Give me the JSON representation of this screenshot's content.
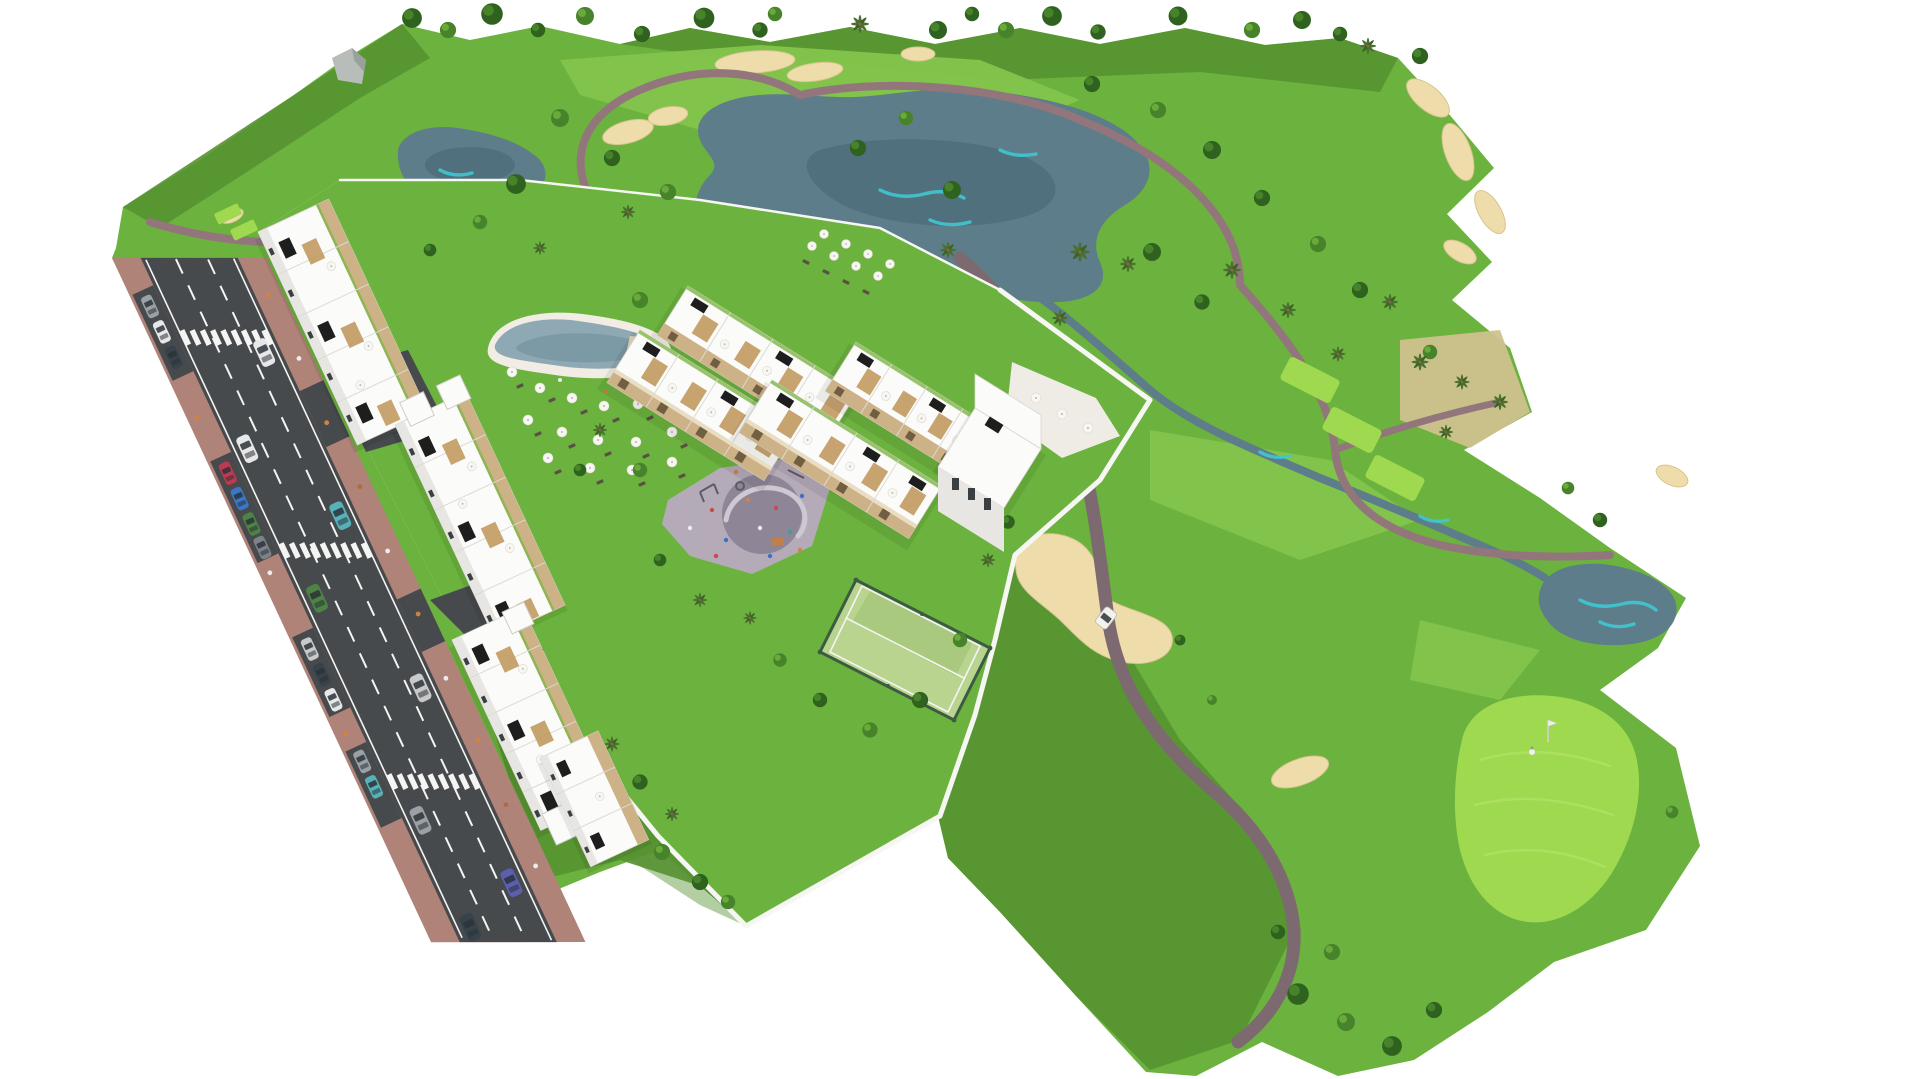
{
  "scene": {
    "kind": "aerial-3d-architectural-render",
    "subject": "golf-resort residential complex with apartment blocks, pool, padel court, playground, access road and golf course",
    "background": "#ffffff"
  },
  "palette": {
    "fairway": "#6cb23e",
    "rough": "#579231",
    "fairway_light": "#83c44c",
    "green_bright": "#9ed94f",
    "scrub": "#cfc28d",
    "sand": "#eedcaa",
    "water": "#5d7d8a",
    "water_deep": "#4d6b78",
    "water_accent": "#3fc8d2",
    "path": "#93767c",
    "path_dark": "#7d6a70",
    "road": "#474a4d",
    "road_line": "#f4f4f2",
    "sidewalk": "#b08379",
    "wall": "#f6f6f3",
    "roof_white": "#fbfbf9",
    "face_shade": "#e7e6e2",
    "face_dark": "#d7d5d0",
    "tan": "#cdb287",
    "wood": "#c29a62",
    "solar": "#1e1e1e",
    "pool": "#8fa9b4",
    "pool_deep": "#7795a2",
    "deck": "#f1ede4",
    "court": "#b9d48e",
    "court_band": "#a9ca7e",
    "fence": "#3c5c42",
    "paving": "#b5abb8",
    "paving_dark": "#8e8597",
    "structure_grey": "#b9bdb9",
    "cart": "#f2f2ef"
  },
  "vehicles": {
    "colors": [
      "#9aa0a5",
      "#e6e7e8",
      "#3a77c9",
      "#bf3a50",
      "#4d8345",
      "#37424a",
      "#58b0b8",
      "#5b5fae",
      "#c8c9cb",
      "#7b8288"
    ]
  },
  "figures": {
    "golfer_blue": "#2f6fd0",
    "golfer_white": "#eef0f2",
    "pedestrian_orange": "#d0833f",
    "pedestrian_white": "#ececec",
    "kid_red": "#c84b4b",
    "kid_blue": "#3f6fc4",
    "kid_teal": "#3f9f94",
    "flag": "#eceff0"
  }
}
